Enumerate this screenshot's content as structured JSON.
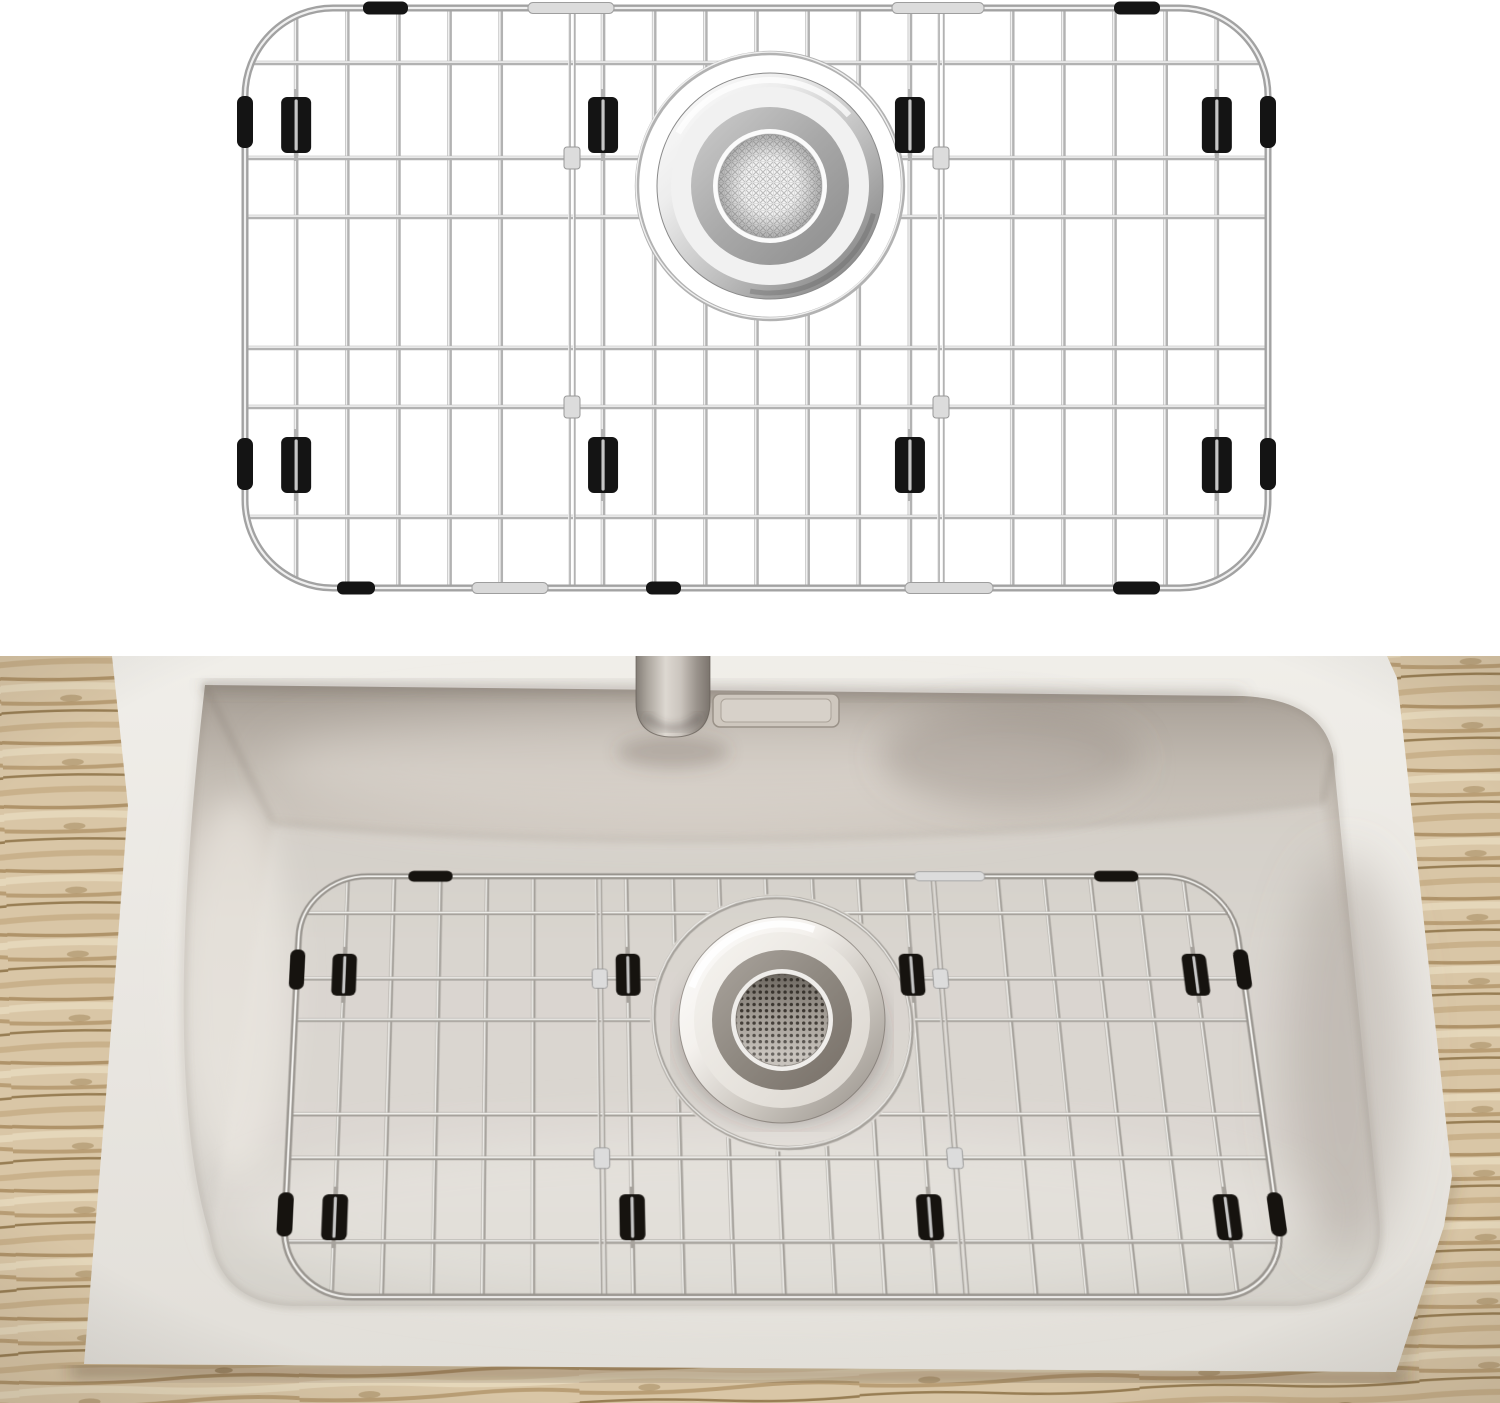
{
  "scene": {
    "domain": "product-image",
    "subject": "stainless-steel sink bottom grid with black rubber bumpers and mesh drain strainer",
    "views": [
      "isolated product render on white background",
      "grid installed in beige drop-in sink on wood countertop"
    ],
    "visible_text": ""
  },
  "palette": {
    "background": "#ffffff",
    "render_wire": "#b2b2b2",
    "photo_wire": "#a6a29c",
    "bumper_black": "#141414",
    "sink_deck": "#eae7e2",
    "sink_wall": "#c6bfb6",
    "sink_floor": "#d9d5cf",
    "wood_light": "#d9c6a6",
    "wood_dark": "#92774c",
    "strainer_ring_render": "#a8a8a8",
    "strainer_ring_photo": "#8e8880"
  },
  "render_grid": {
    "id": "rg",
    "x": 245,
    "y": 8,
    "w": 1023,
    "h": 580,
    "rx": 88,
    "wires": 19,
    "h_ys": [
      63,
      158,
      217,
      348,
      407,
      517
    ],
    "feeders": [
      572,
      941
    ],
    "junction_ys": [
      158,
      407
    ],
    "hole": {
      "cx": 770,
      "cy": 186,
      "rx": 132,
      "ry": 132
    },
    "ring": {
      "rx": 133,
      "ry": 133
    },
    "clips": {
      "wires": [
        1,
        7,
        13,
        19
      ],
      "rows": [
        97,
        437
      ],
      "w": 30,
      "h": 56
    },
    "edge_rows": [
      96,
      438
    ],
    "edge_h": 52,
    "top_black": [
      [
        363,
        45
      ],
      [
        1114,
        46
      ]
    ],
    "top_silver": [
      [
        528,
        86
      ],
      [
        892,
        92
      ]
    ],
    "bottom_black": [
      [
        337,
        38
      ],
      [
        646,
        35
      ],
      [
        1113,
        47
      ]
    ],
    "bottom_silver": [
      [
        472,
        76
      ],
      [
        905,
        88
      ]
    ],
    "palette": {
      "wire_dark": "#b2b2b2",
      "wire_light": "#f0f0f0",
      "frame_dark": "#a2a2a2",
      "bumper": "#141414"
    }
  },
  "photo_grid": {
    "id": "pg",
    "x": 4,
    "y": 4,
    "w": 1008,
    "h": 462,
    "rx": 72,
    "wires": 19,
    "h_ys": [
      47.8,
      123.5,
      170.5,
      274.8,
      321.8,
      409.4
    ],
    "feeders": [
      326.6,
      689.4
    ],
    "junction_ys": [
      123.5,
      321.8
    ],
    "hole": {
      "cx": 519,
      "cy": 170,
      "rx": 140,
      "ry": 145
    },
    "ring": {
      "rx": 136,
      "ry": 141
    },
    "clips": {
      "wires": [
        1,
        7,
        13,
        19
      ],
      "rows": [
        95,
        360
      ],
      "w": 26,
      "h": 48
    },
    "edge_rows": [
      90,
      358
    ],
    "edge_h": 46,
    "top_black": [
      [
        120,
        48
      ],
      [
        865,
        48
      ]
    ],
    "top_silver": [
      [
        670,
        76
      ]
    ],
    "bottom_black": [],
    "bottom_silver": [],
    "palette": {
      "wire_dark": "#a6a29c",
      "wire_light": "#f4f3f0",
      "frame_dark": "#98948e",
      "bumper": "#16130f"
    }
  }
}
